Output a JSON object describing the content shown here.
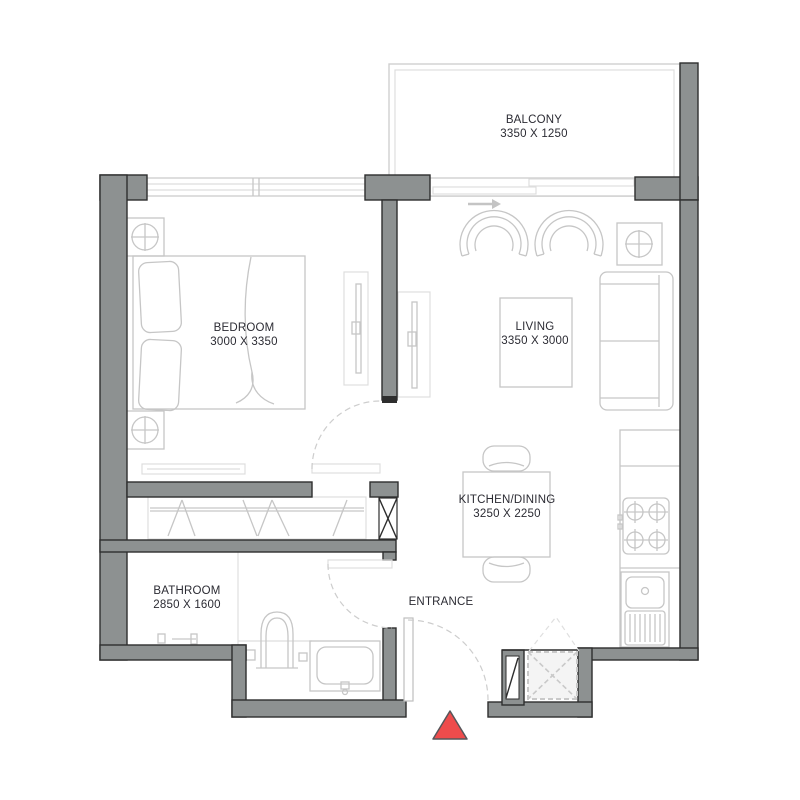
{
  "rooms": {
    "balcony": {
      "name": "BALCONY",
      "dims": "3350 X 1250"
    },
    "bedroom": {
      "name": "BEDROOM",
      "dims": "3000 X 3350"
    },
    "living": {
      "name": "LIVING",
      "dims": "3350 X 3000"
    },
    "kitchen_dining": {
      "name": "KITCHEN/DINING",
      "dims": "3250 X 2250"
    },
    "bathroom": {
      "name": "BATHROOM",
      "dims": "2850 X 1600"
    },
    "entrance": {
      "name": "ENTRANCE"
    }
  },
  "colors": {
    "wall_fill": "#8d9191",
    "wall_outline": "#2e2e2e",
    "furniture_line": "#c6c6c6",
    "furniture_line_light": "#dedede",
    "dashed_line": "#cdcdcd",
    "label_text": "#2b2b33",
    "marker_red": "#ee4c4c",
    "floor": "#ffffff"
  }
}
